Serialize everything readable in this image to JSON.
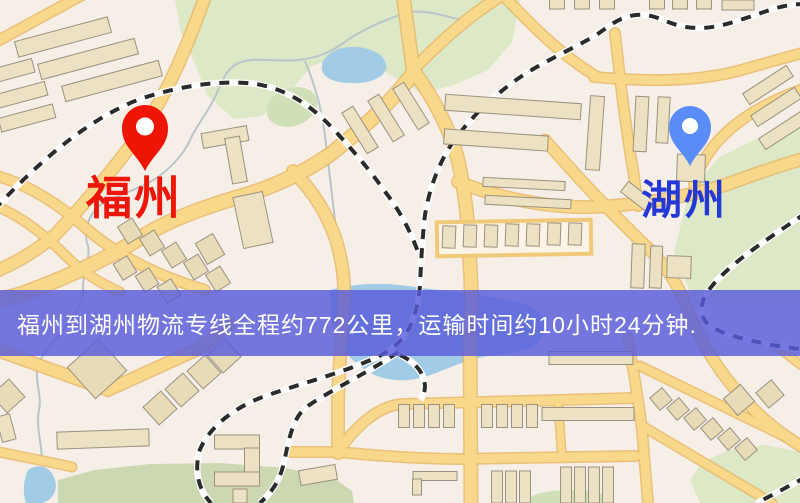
{
  "map": {
    "markers": [
      {
        "name": "福州",
        "role": "origin",
        "pin_color": "#ee1505",
        "label_color": "#ee1509"
      },
      {
        "name": "湖州",
        "role": "destination",
        "pin_color": "#5a8cf7",
        "label_color": "#2438d8"
      }
    ],
    "banner": {
      "text": "福州到湖州物流专线全程约772公里，运输时间约10小时24分钟.",
      "background": "rgba(88,91,219,0.82)",
      "text_color": "#ffffff"
    },
    "route_summary": {
      "from": "福州",
      "to": "湖州",
      "distance_text": "约772公里",
      "duration_text": "约10小时24分钟"
    }
  }
}
